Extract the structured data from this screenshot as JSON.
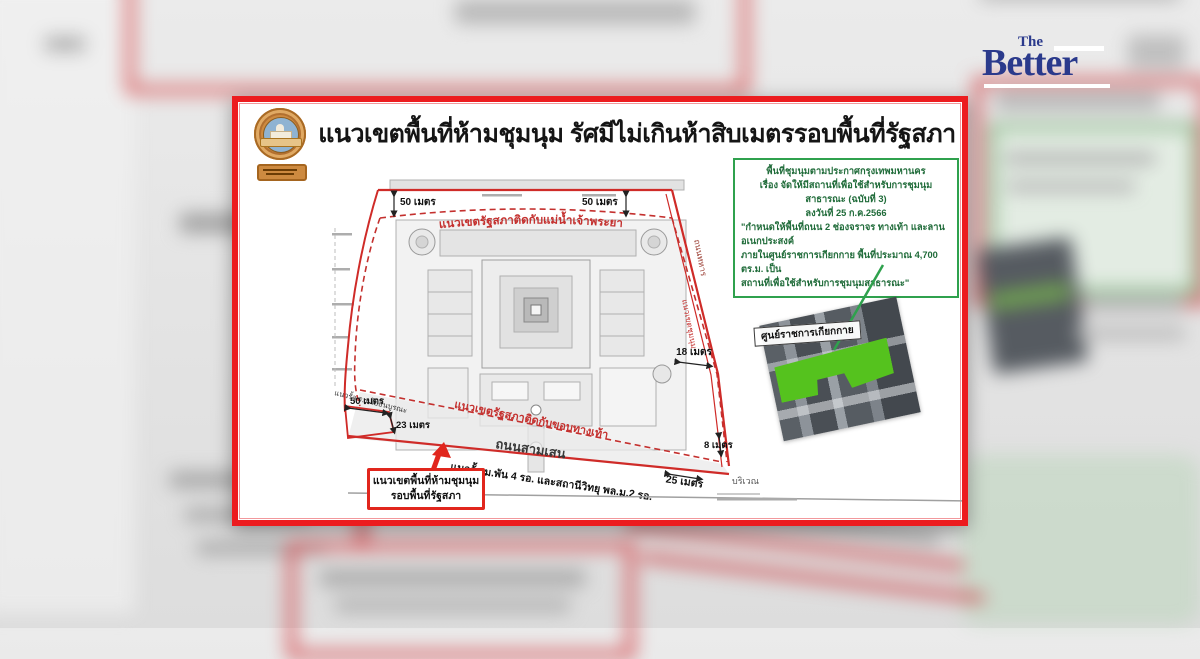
{
  "brand": {
    "the": "The",
    "better": "Better"
  },
  "card": {
    "title": "แนวเขตพื้นที่ห้ามชุมนุม รัศมีไม่เกินห้าสิบเมตรรอบพื้นที่รัฐสภา",
    "green_box": {
      "lines": [
        "พื้นที่ชุมนุมตามประกาศกรุงเทพมหานคร",
        "เรื่อง จัดให้มีสถานที่เพื่อใช้สำหรับการชุมนุมสาธารณะ (ฉบับที่ 3)",
        "ลงวันที่ 25 ก.ค.2566",
        "\"กำหนดให้พื้นที่ถนน 2 ช่องจราจร ทางเท้า และลานอเนกประสงค์",
        "ภายในศูนย์ราชการเกียกกาย พื้นที่ประมาณ 4,700 ตร.ม. เป็น",
        "สถานที่เพื่อใช้สำหรับการชุมนุมสาธารณะ\""
      ]
    },
    "map": {
      "boundary_river_label": "แนวเขตรัฐสภาติดกับแม่น้ำเจ้าพระยา",
      "boundary_footpath_label": "แนวเขตรัฐสภาติดกับขอบทางเท้า",
      "road_samsen": "ถนนสามเสน",
      "road_thahan": "ถนนทหาร",
      "inner_boundary_label": "แนวเขตชุมนุม",
      "fence_label": "แนวรั้ว ม.พัน 4 รอ. และสถานีวิทยุ พล.ม.2 รอ.",
      "fence_school_label": "แนวรั้ว ร.ร.โยธินบูรณะ",
      "area_label": "บริเวณ",
      "m50_top_left": "50 เมตร",
      "m50_top_right": "50 เมตร",
      "m50_bottom_left": "50 เมตร",
      "m23": "23 เมตร",
      "m18": "18 เมตร",
      "m8": "8 เมตร",
      "m25": "25 เมตร"
    },
    "aerial_label": "ศูนย์ราชการเกียกกาย",
    "warning_box": {
      "line1": "แนวเขตพื้นที่ห้ามชุมนุม",
      "line2": "รอบพื้นที่รัฐสภา"
    }
  },
  "colors": {
    "card_border": "#ec1c1f",
    "map_red": "#c4302e",
    "green_border": "#2fa14d",
    "green_text": "#1f6b39",
    "logo_navy": "#2b3a8c",
    "assembly_green": "#55c21e"
  }
}
